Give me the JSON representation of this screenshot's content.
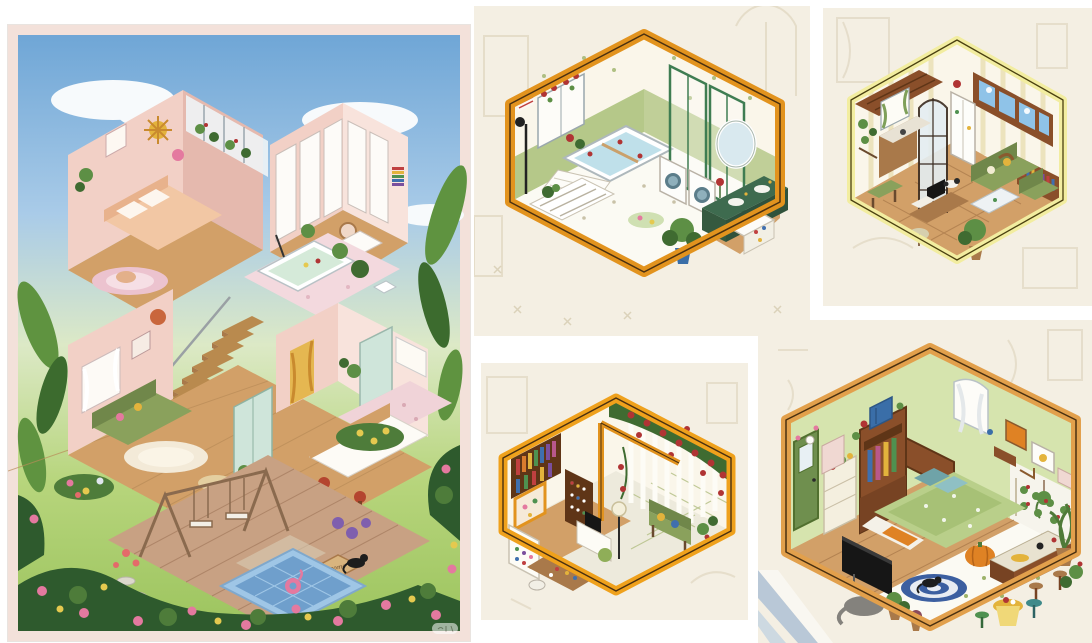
{
  "palette": {
    "paper": "#ffffff",
    "p1Border": "#f3e1da",
    "sky": "#6fa6d6",
    "skyLight": "#a9cbe8",
    "cloud": "#f7fafc",
    "lawn": "#b7d57c",
    "lawnDark": "#9cc45e",
    "hedge": "#2e5a2d",
    "hedgeLight": "#4e7c3a",
    "rosePink": "#e4799f",
    "roseYellow": "#e5c94f",
    "roseRed": "#b03434",
    "leaf": "#5f9340",
    "leafDark": "#3c6b2e",
    "pinkWall": "#f2d0c6",
    "pinkWallDk": "#e5b9ae",
    "pinkWallLt": "#f8e3dc",
    "wood": "#d2a068",
    "woodDk": "#a9794a",
    "deck": "#c8a183",
    "deckDk": "#a87f62",
    "stair": "#b98a4e",
    "sofa": "#8aa15c",
    "sofaDk": "#70874a",
    "mint": "#cfe5da",
    "pool": "#9fc6e6",
    "poolDk": "#6f9fcc",
    "frameOrange": "#e2931e",
    "frameYellow": "#f2eda0",
    "frameAmber": "#efa11c",
    "frameTan": "#e2a04c",
    "fadedBg": "#f4efe3",
    "fadedInk": "#d8cdb4",
    "cream": "#faf6ea",
    "stripe": "#ece3bd",
    "wainscot": "#b5c889",
    "glassGreen": "#3f7d52",
    "tile": "#fbfaf3",
    "tileDot": "#c9c2a8",
    "mirror": "#d9e9ef",
    "water": "#bfe0ea",
    "vanity": "#3e6b4f",
    "potBlue": "#3a6ea8",
    "plant": "#5d8f45",
    "plantDk": "#3f6b31",
    "brown": "#8a4f2a",
    "brownDk": "#5f3517",
    "bookRed": "#c04040",
    "bookBlue": "#3f6fae",
    "bookGreen": "#4f9150",
    "bookYellow": "#e3b33c",
    "bookPurple": "#7a4f9e",
    "wallGreen": "#d6e4ae",
    "doorGreen": "#6f8f4e",
    "bedGreen": "#b9cf8a",
    "bedGreenDk": "#93b05e",
    "tv": "#161616",
    "pumpkin": "#df8224",
    "rugBlue": "#3c5fa0",
    "offWhite": "#f6f4ec",
    "cat": "#1d1d1d",
    "skyPane": "#8fc3e8"
  },
  "collage": {
    "background": "#ffffff",
    "panels": [
      {
        "label": "Isometric dollhouse painting: two-story pink house cutaway with bedroom, walk-in closet, bathroom, living room, kitchen, staircase, wooden deck with swing, plunge pool with flamingo float, black cat on welcome mat, and rose garden under a blue sky"
      },
      {
        "label": "Isometric bathroom illustration in an orange frame: floral wallpaper with green wainscoting, flower-filled bathtub, glass shower partition, washer and dryer, dark green vanity with round mirror, potted monstera, faded room sketch behind"
      },
      {
        "label": "Isometric living room and kitchen illustration in a pale yellow frame: striped wallpaper, brown clerestory windows with sky, green sofa set, bookshelf, arched window, kitchen corner with fridge, computer desk and dog on parquet floor"
      },
      {
        "label": "Isometric craft room and rose patio illustration in an orange frame: rainbow bookshelf, marker shelf, washi-tape cabinet, craft desk, and a white-fenced patio covered in red climbing roses with a garden bench"
      },
      {
        "label": "Isometric bedroom illustration in an amber frame: light green walls, green door, wardrobe with hanging clothes, wooden bed with floral duvet, TV, pumpkin pouf, striped round rug with black cat, breakfast counter with stools and many potted plants"
      }
    ],
    "panel1": {
      "mat_text": "welcome"
    },
    "watermark": {
      "label": "faint translucent watermark badge"
    }
  }
}
